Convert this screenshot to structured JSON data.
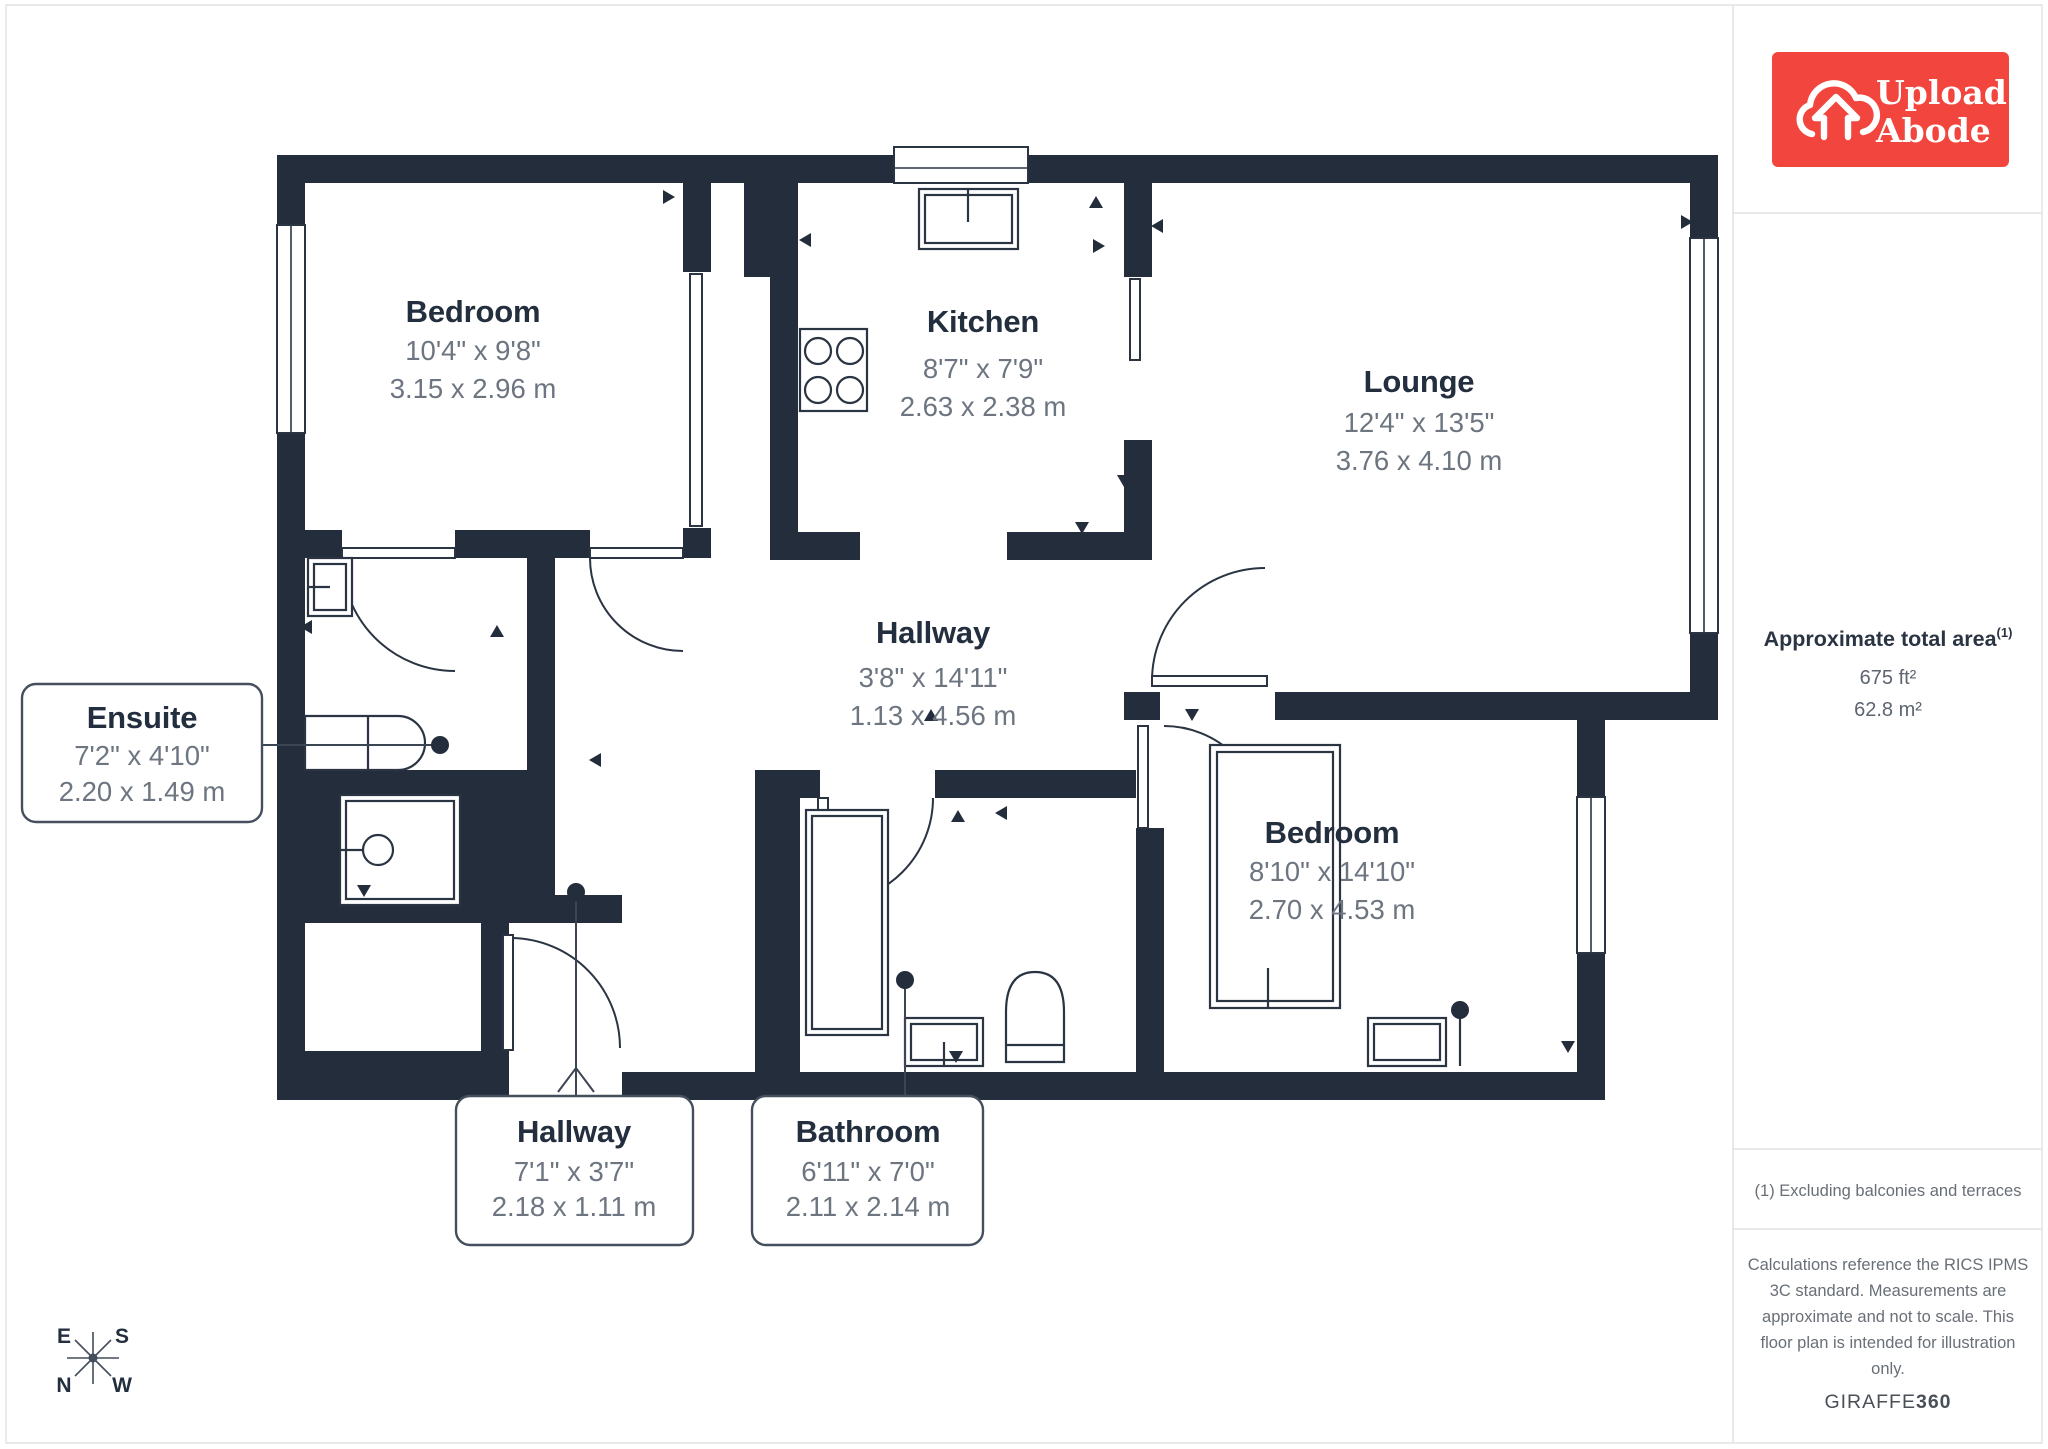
{
  "logo": {
    "line1": "Upload",
    "line2": "Abode"
  },
  "sidebar": {
    "area_title": "Approximate total area",
    "area_sup": "(1)",
    "area_ft": "675 ft²",
    "area_m": "62.8 m²",
    "note": "(1) Excluding balconies and terraces",
    "disclaimer_lines": [
      "Calculations reference the RICS IPMS",
      "3C standard. Measurements are",
      "approximate and not to scale. This",
      "floor plan is intended for illustration",
      "only."
    ],
    "brand_regular": "GIRAFFE",
    "brand_bold": "360"
  },
  "rooms": [
    {
      "name": "Bedroom",
      "imperial": "10'4\" x 9'8\"",
      "metric": "3.15 x 2.96 m"
    },
    {
      "name": "Kitchen",
      "imperial": "8'7\" x 7'9\"",
      "metric": "2.63 x 2.38 m"
    },
    {
      "name": "Lounge",
      "imperial": "12'4\" x 13'5\"",
      "metric": "3.76 x 4.10 m"
    },
    {
      "name": "Hallway",
      "imperial": "3'8\" x 14'11\"",
      "metric": "1.13 x 4.56 m"
    },
    {
      "name": "Bedroom",
      "imperial": "8'10\" x 14'10\"",
      "metric": "2.70 x 4.53 m"
    }
  ],
  "callouts": [
    {
      "name": "Ensuite",
      "imperial": "7'2\" x 4'10\"",
      "metric": "2.20 x 1.49 m"
    },
    {
      "name": "Hallway",
      "imperial": "7'1\" x 3'7\"",
      "metric": "2.18 x 1.11 m"
    },
    {
      "name": "Bathroom",
      "imperial": "6'11\" x 7'0\"",
      "metric": "2.11 x 2.14 m"
    }
  ],
  "compass": {
    "e": "E",
    "s": "S",
    "n": "N",
    "w": "W"
  },
  "colors": {
    "wall": "#232d3b",
    "dim_text": "#6d7580",
    "title_text": "#232e3e",
    "logo_red": "#f2453d"
  }
}
